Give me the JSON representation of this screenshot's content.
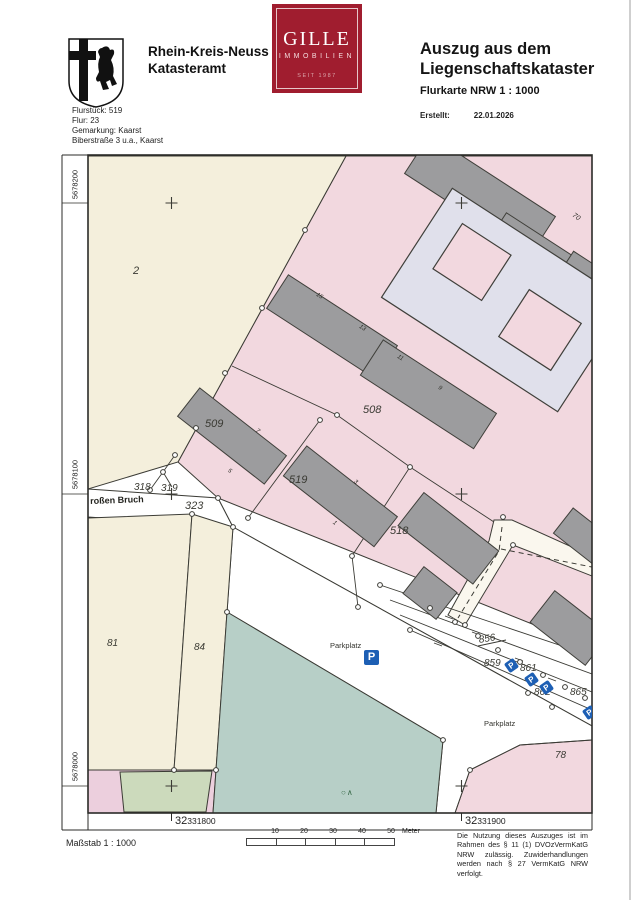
{
  "header": {
    "authority": {
      "line1": "Rhein-Kreis-Neuss",
      "line2": "Katasteramt"
    },
    "parcel_info": [
      "Flurstück: 519",
      "Flur: 23",
      "Gemarkung: Kaarst",
      "Biberstraße 3 u.a., Kaarst"
    ],
    "logo": {
      "name": "GILLE",
      "subtitle": "IMMOBILIEN",
      "since": "SEIT 1987"
    },
    "title": {
      "line1": "Auszug aus dem",
      "line2": "Liegenschaftskataster"
    },
    "subtitle": "Flurkarte NRW 1 : 1000",
    "created": {
      "label": "Erstellt:",
      "date": "22.01.2026"
    }
  },
  "map": {
    "grid": {
      "left": [
        "5678200",
        "5678100",
        "5678000"
      ],
      "bottom": [
        {
          "zone": "32",
          "easting": "331800"
        },
        {
          "zone": "32",
          "easting": "331900"
        }
      ]
    },
    "street_name": "roßen Bruch",
    "parcels": {
      "p2": "2",
      "p318": "318",
      "p319": "319",
      "p323": "323",
      "p509": "509",
      "p508": "508",
      "p519": "519",
      "p518": "518",
      "p81": "81",
      "p84": "84",
      "p856": "856",
      "p859": "859",
      "p861": "861",
      "p862": "862",
      "p865": "865",
      "p78": "78"
    },
    "house_numbers": [
      "15",
      "13",
      "11",
      "9",
      "7",
      "5",
      "3",
      "1",
      "70"
    ],
    "area_labels": {
      "parkplatz1": "Parkplatz",
      "parkplatz2": "Parkplatz"
    },
    "symbols": {
      "parking": "P",
      "tree": "○∧"
    },
    "colors": {
      "parcel_pink": "#f2d8df",
      "parcel_cream": "#f4efdc",
      "parcel_teal": "#b7cfc7",
      "parcel_green": "#ccdabc",
      "building_gray": "#9c9c9e",
      "building_light": "#e0e0eb",
      "parking_blue": "#1d5fb4",
      "brand_red": "#a01d2f"
    }
  },
  "footer": {
    "scale_label": "Maßstab 1 : 1000",
    "scale_bar": {
      "ticks": [
        "10",
        "20",
        "30",
        "40",
        "50"
      ],
      "unit": "Meter"
    },
    "legal": "Die Nutzung dieses Auszuges ist im Rahmen des § 11 (1) DVOzVermKatG NRW zulässig. Zuwiderhandlungen werden nach § 27 VermKatG NRW verfolgt."
  }
}
